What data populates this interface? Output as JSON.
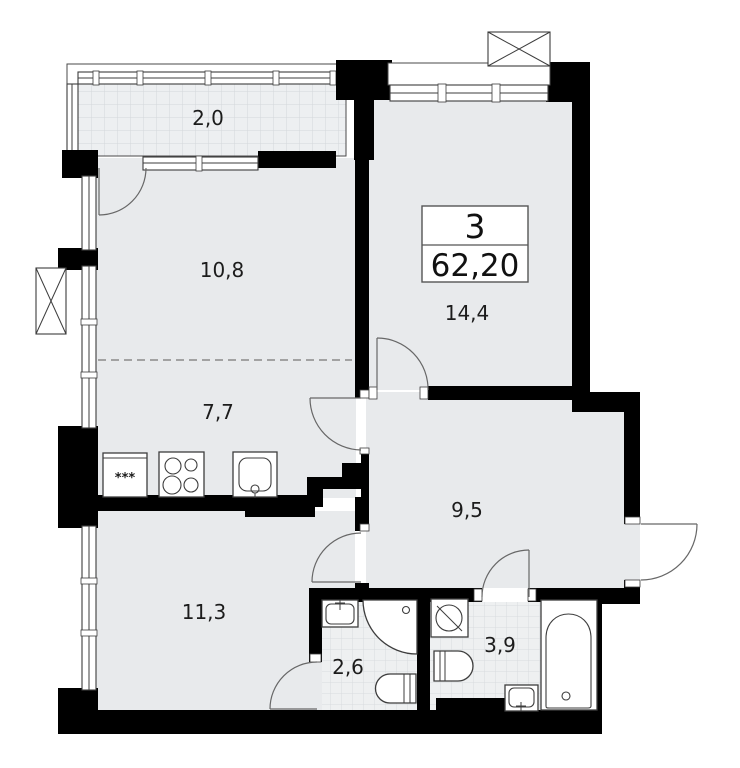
{
  "plan": {
    "info_box": {
      "rooms_count": "3",
      "total_area": "62,20"
    },
    "room_labels": {
      "balcony": "2,0",
      "living_room": "10,8",
      "kitchen": "7,7",
      "bedroom_main": "14,4",
      "hallway": "9,5",
      "bedroom_second": "11,3",
      "shower_room": "2,6",
      "bathroom": "3,9"
    },
    "fridge_symbol": "***",
    "colors": {
      "walls": "#000000",
      "floor": "#e8eaec",
      "tiled_floor": "#edeff1",
      "grid_lines": "#d3d7da",
      "outlines": "#3d3d3d",
      "door_arcs": "#676767",
      "background": "#ffffff"
    }
  }
}
